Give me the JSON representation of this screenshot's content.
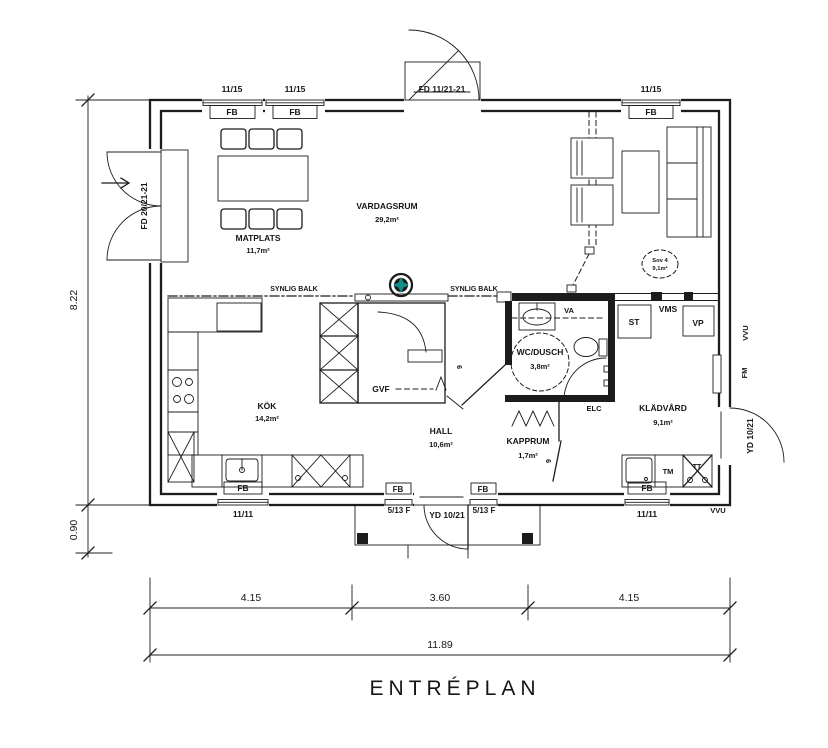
{
  "title": "ENTRÉPLAN",
  "rooms": [
    {
      "name": "MATPLATS",
      "area": "11,7m²"
    },
    {
      "name": "VARDAGSRUM",
      "area": "29,2m²"
    },
    {
      "name": "KÖK",
      "area": "14,2m²"
    },
    {
      "name": "HALL",
      "area": "10,6m²"
    },
    {
      "name": "KAPPRUM",
      "area": "1,7m²"
    },
    {
      "name": "WC/DUSCH",
      "area": "3,8m²"
    },
    {
      "name": "KLÄDVÅRD",
      "area": "9,1m²"
    }
  ],
  "optional_room": {
    "name": "Sov 4",
    "area": "9,1m²"
  },
  "openings": {
    "window_top": "11/15",
    "window_bottom": "11/11",
    "window_frame": "FB",
    "sidelight": "5/13 F",
    "door_top": "FD 11/21-21",
    "door_left": "FD 20/21-21",
    "door_yd": "YD 10/21",
    "door_width": "9"
  },
  "annotations": {
    "synlig_balk": "SYNLIG BALK",
    "gvf": "GVF",
    "va": "VA",
    "st": "ST",
    "vms": "VMS",
    "vp": "VP",
    "elc": "ELC",
    "fm": "FM",
    "tm": "TM",
    "tt": "TT",
    "vvu": "VVU"
  },
  "dimensions": {
    "height": "8.22",
    "porch": "0.90",
    "segments": [
      "4.15",
      "3.60",
      "4.15"
    ],
    "total": "11.89"
  },
  "colors": {
    "line": "#1c1c1c",
    "chimney_star": "#0f8f86"
  }
}
